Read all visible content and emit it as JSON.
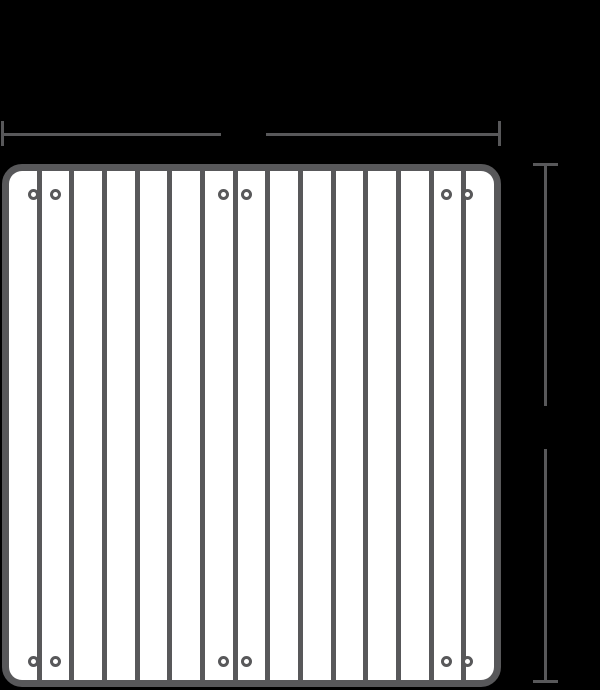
{
  "colors": {
    "background": "#000000",
    "line": "#58585a",
    "panel_fill": "#ffffff"
  },
  "panel": {
    "slat_count": 15,
    "divider_count": 14,
    "divider_width_px": 5
  },
  "screws": {
    "row_y": [
      194,
      661
    ],
    "pair_x": [
      [
        33,
        55
      ],
      [
        223,
        246
      ],
      [
        446,
        467
      ]
    ],
    "outer_diameter_px": 11
  },
  "dimensions": {
    "width_line": {
      "label": ""
    },
    "height_line": {
      "label": ""
    }
  }
}
